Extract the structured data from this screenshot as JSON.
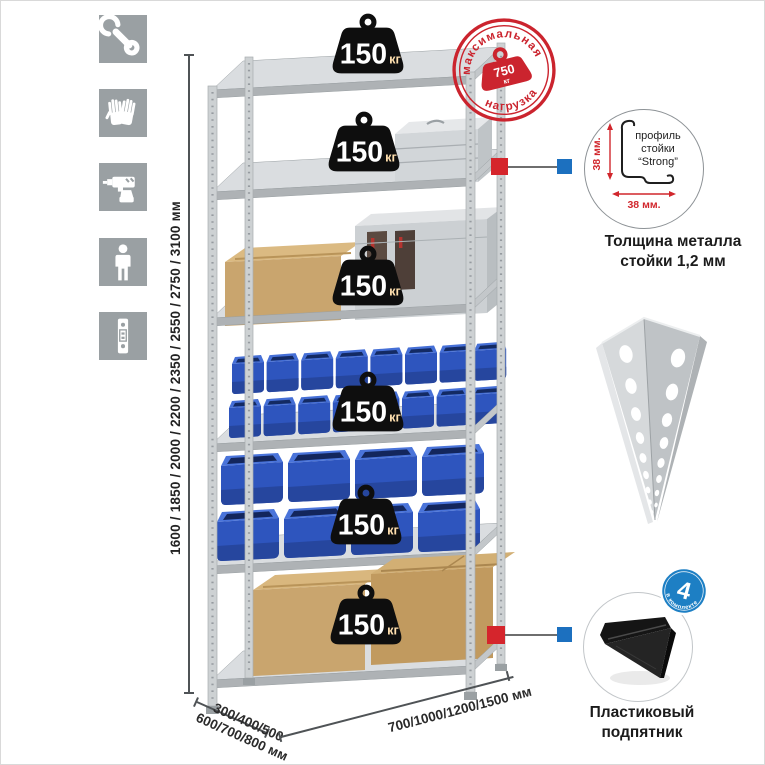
{
  "sidebar_icons": [
    {
      "name": "wrench-icon"
    },
    {
      "name": "gloves-icon"
    },
    {
      "name": "drill-icon"
    },
    {
      "name": "person-icon"
    },
    {
      "name": "rack-profile-icon"
    }
  ],
  "dimensions": {
    "height": "1600 / 1850 / 2000 / 2200 / 2350 / 2550 / 2750 / 3100 мм",
    "depth_line1": "300/400/500",
    "depth_line2": "600/700/800 мм",
    "width": "700/1000/1200/1500 мм"
  },
  "stamp": {
    "arc_top": "максимальная",
    "arc_bottom": "нагрузка",
    "value": "750",
    "unit": "кг"
  },
  "shelf_load": {
    "value": "150",
    "unit": "кг",
    "badge_count": 6
  },
  "profile_callout": {
    "dim_vertical": "38 мм.",
    "dim_horizontal": "38 мм.",
    "label_line1": "профиль",
    "label_line2": "стойки",
    "label_line3": "“Strong”",
    "caption_line1": "Толщина металла",
    "caption_line2": "стойки 1,2 мм"
  },
  "foot_callout": {
    "badge_number": "4",
    "badge_text": "в комплекте",
    "caption_line1": "Пластиковый",
    "caption_line2": "подпятник"
  },
  "colors": {
    "accent_red": "#cb242e",
    "marker_red": "#d5252c",
    "marker_blue": "#1c70bf",
    "badge_blue": "#1d7fc4",
    "icon_gray": "#9aa0a3",
    "bin_blue": "#2e55be",
    "cardboard": "#c9a56e",
    "metal_gray": "#cdd1d3"
  }
}
